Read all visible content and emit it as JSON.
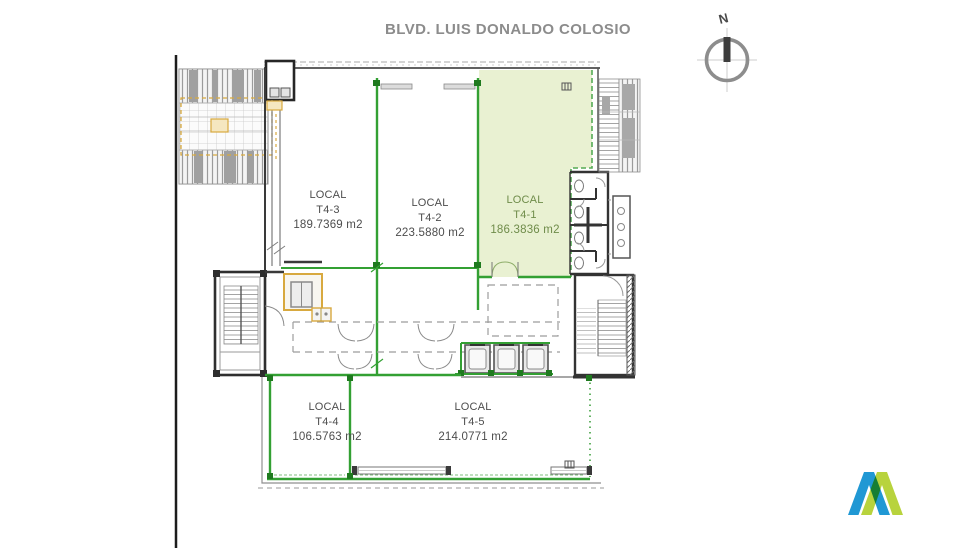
{
  "street": {
    "name": "BLVD. LUIS DONALDO COLOSIO"
  },
  "compass": {
    "north_label": "N"
  },
  "plan": {
    "locals": [
      {
        "label": "LOCAL",
        "unit": "T4-3",
        "area": "189.7369 m2",
        "highlighted": false
      },
      {
        "label": "LOCAL",
        "unit": "T4-2",
        "area": "223.5880 m2",
        "highlighted": false
      },
      {
        "label": "LOCAL",
        "unit": "T4-1",
        "area": "186.3836 m2",
        "highlighted": true
      },
      {
        "label": "LOCAL",
        "unit": "T4-4",
        "area": "106.5763 m2",
        "highlighted": false
      },
      {
        "label": "LOCAL",
        "unit": "T4-5",
        "area": "214.0771 m2",
        "highlighted": false
      }
    ]
  },
  "colors": {
    "highlight_fill": "#e9f1d2",
    "highlight_wall": "#33a033",
    "highlight_dash": "#55ab55",
    "highlight_text": "#6f8c4a",
    "label_text": "#4d4d4d",
    "title_text": "#8c8c8c",
    "accent_orange": "#d8a93f",
    "logo_blue": "#2098d4",
    "logo_green": "#b2cf2c"
  }
}
